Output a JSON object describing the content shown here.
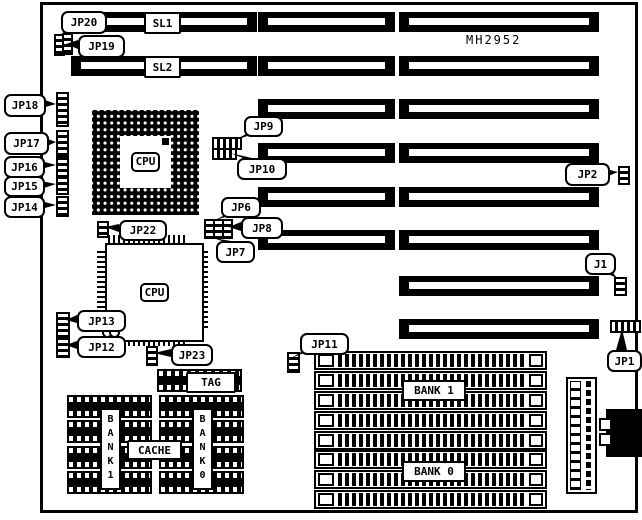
{
  "model": "MH2952",
  "slots": {
    "sl1": "SL1",
    "sl2": "SL2"
  },
  "chips": {
    "cpu_socket": "CPU",
    "cpu_qfp": "CPU",
    "tag": "TAG",
    "cache": "CACHE",
    "bank1_column": "BANK1",
    "bank0_column": "BANK0"
  },
  "memory_banks": {
    "bank1": "BANK 1",
    "bank0": "BANK 0"
  },
  "callouts": {
    "jp1": "JP1",
    "jp2": "JP2",
    "jp6": "JP6",
    "jp7": "JP7",
    "jp8": "JP8",
    "jp9": "JP9",
    "jp10": "JP10",
    "jp11": "JP11",
    "jp12": "JP12",
    "jp13": "JP13",
    "jp14": "JP14",
    "jp15": "JP15",
    "jp16": "JP16",
    "jp17": "JP17",
    "jp18": "JP18",
    "jp19": "JP19",
    "jp20": "JP20",
    "jp22": "JP22",
    "jp23": "JP23",
    "j1": "J1"
  },
  "colors": {
    "ink": "#000000",
    "paper": "#ffffff"
  }
}
